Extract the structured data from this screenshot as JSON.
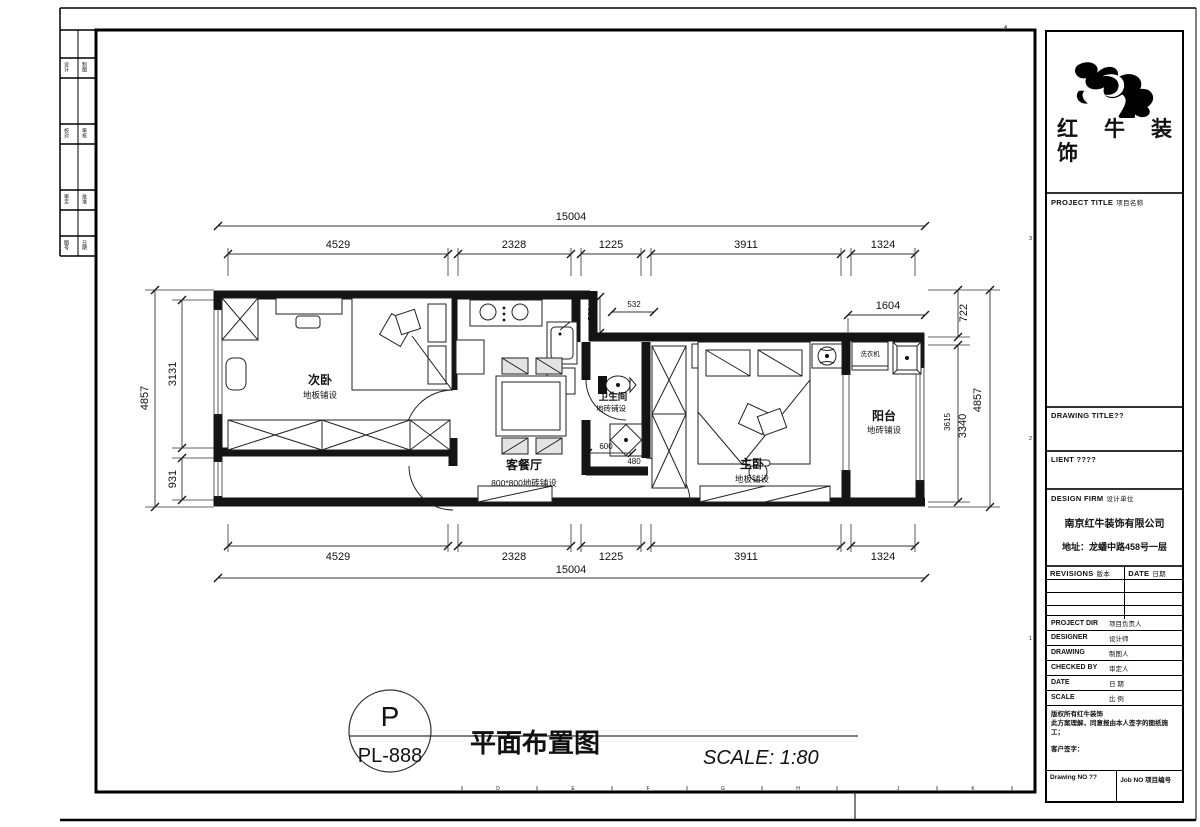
{
  "brand": {
    "chars": [
      "红",
      "牛",
      "装",
      "饰"
    ]
  },
  "strip": {
    "labels": [
      "设计",
      "制图",
      "校对",
      "审核",
      "审定",
      "批准",
      "图号",
      "日期"
    ]
  },
  "zone": {
    "digits": [
      "4",
      "3",
      "2",
      "1"
    ]
  },
  "ruler": {
    "letters": [
      "D",
      "E",
      "F",
      "G",
      "H",
      "J",
      "K"
    ]
  },
  "title_block": {
    "project_title_en": "PROJECT TITLE",
    "project_title_cn": "项目名称",
    "drawing_title_en": "DRAWING TITLE??",
    "client_en": "LIENT ????",
    "design_firm_en": "DESIGN FIRM",
    "design_firm_cn": "设计单位",
    "firm_name": "南京红牛装饰有限公司",
    "firm_address": "地址：龙蟠中路458号一层",
    "revisions_en": "REVISIONS",
    "revisions_cn": "版本",
    "date_en": "DATE",
    "date_cn": "日期",
    "rows": [
      {
        "en": "PROJECT DIR",
        "cn": "项目负责人"
      },
      {
        "en": "DESIGNER",
        "cn": "设计师"
      },
      {
        "en": "DRAWING",
        "cn": "制图人"
      },
      {
        "en": "CHECKED BY",
        "cn": "审定人"
      },
      {
        "en": "DATE",
        "cn": "日 期"
      },
      {
        "en": "SCALE",
        "cn": "比 例"
      }
    ],
    "copyright_line1": "版权所有红牛装饰",
    "copyright_line2": "此方案理解，同意报由本人签字的图纸施工；",
    "copyright_line3": "客户签字：",
    "drawing_no_label": "Drawing NO ??",
    "job_no_label": "Job NO 项目编号"
  },
  "plan": {
    "rooms": [
      {
        "name": "次卧",
        "sub": "地板铺设"
      },
      {
        "name": "客餐厅",
        "sub": "800*800地砖铺设"
      },
      {
        "name": "卫生间",
        "sub": "地砖铺设"
      },
      {
        "name": "主卧",
        "sub": "地板铺设"
      },
      {
        "name": "阳台",
        "sub": "地砖铺设"
      }
    ],
    "appliances": {
      "washer": "洗衣机"
    },
    "dims": {
      "top_total": "15004",
      "top_segments": [
        "4529",
        "2328",
        "1225",
        "3911",
        "1324"
      ],
      "bottom_segments": [
        "4529",
        "2328",
        "1225",
        "3911",
        "1324"
      ],
      "bottom_total": "15004",
      "left_total": "4857",
      "left_upper": "3131",
      "left_lower": "931",
      "right_top": "722",
      "right_mid": "3340",
      "right_mid_alt": "3615",
      "right_total": "4857",
      "balcony_width": "1604",
      "jog_v": "536",
      "jog_h": "532",
      "bath_w": "600",
      "shower_w": "480"
    }
  },
  "footer": {
    "tag_top": "P",
    "tag_bottom": "PL-888",
    "drawing_title": "平面布置图",
    "scale": "SCALE: 1:80"
  }
}
